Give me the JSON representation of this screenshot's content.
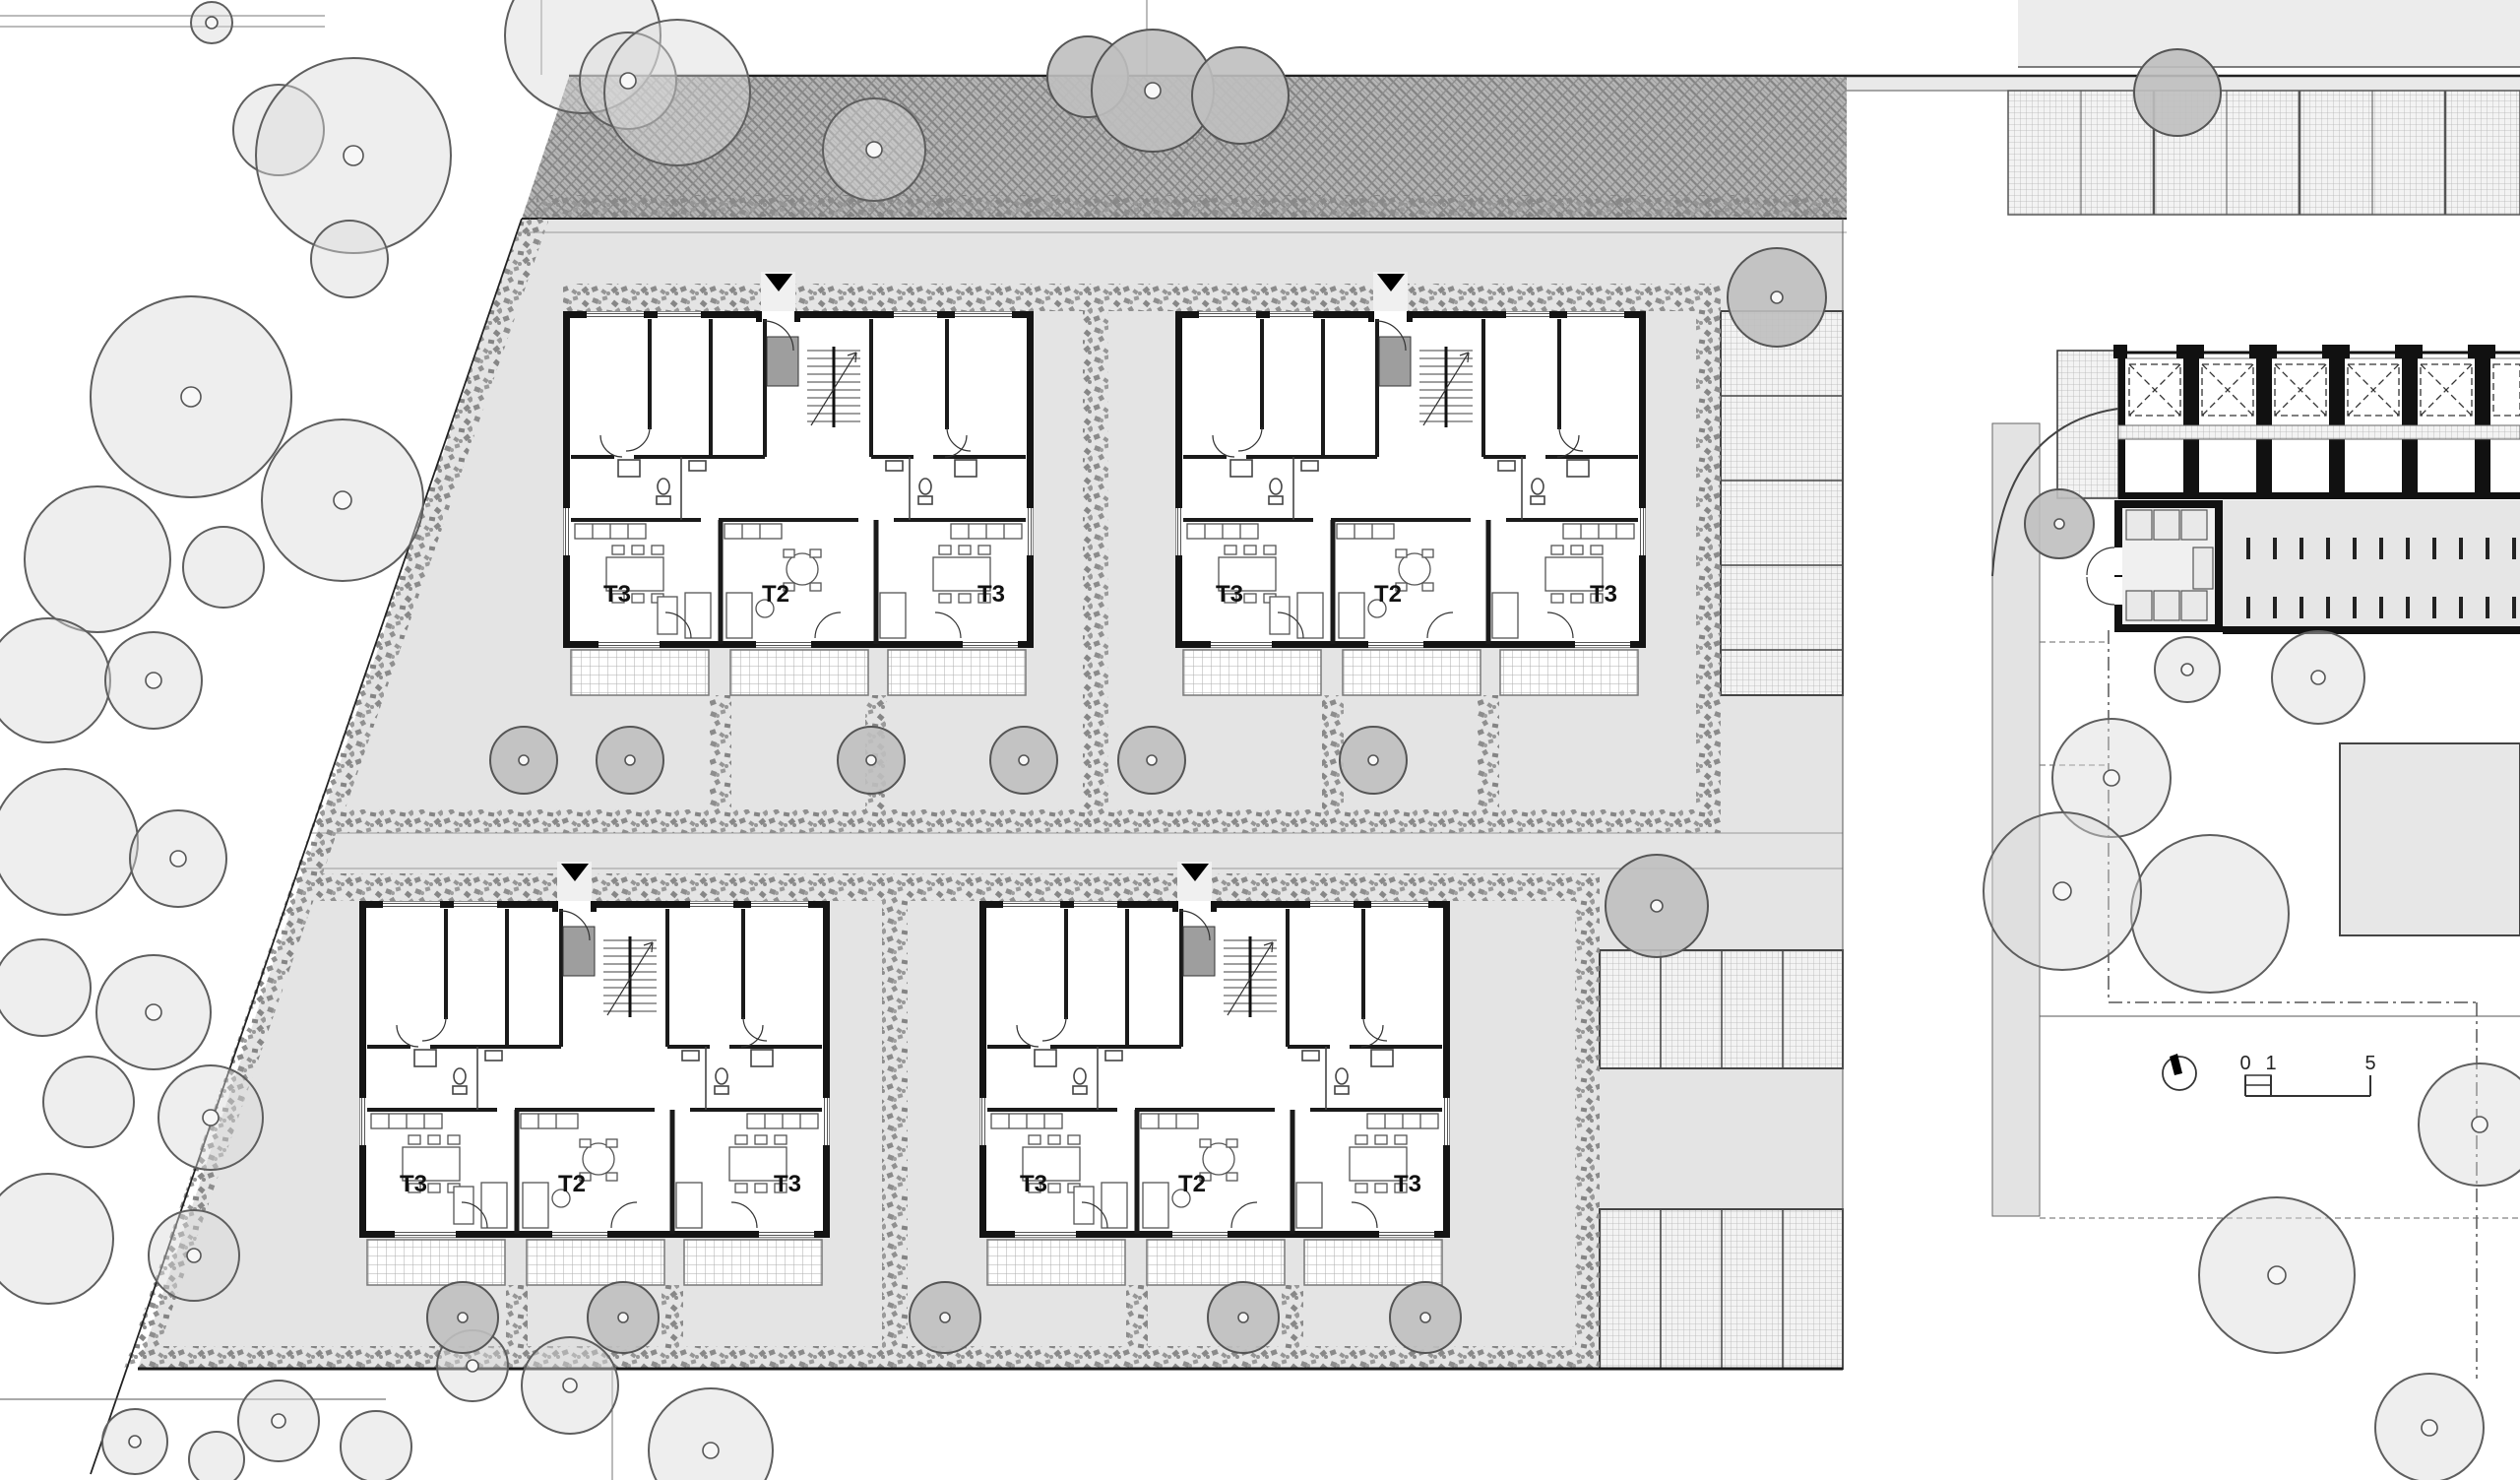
{
  "plan": {
    "kind": "architectural-site-plan",
    "floor": "ground-floor"
  },
  "buildings": [
    {
      "id": "building-a",
      "units": [
        {
          "label": "T3"
        },
        {
          "label": "T2"
        },
        {
          "label": "T3"
        }
      ]
    },
    {
      "id": "building-b",
      "units": [
        {
          "label": "T3"
        },
        {
          "label": "T2"
        },
        {
          "label": "T3"
        }
      ]
    },
    {
      "id": "building-c",
      "units": [
        {
          "label": "T3"
        },
        {
          "label": "T2"
        },
        {
          "label": "T3"
        }
      ]
    },
    {
      "id": "building-d",
      "units": [
        {
          "label": "T3"
        },
        {
          "label": "T2"
        },
        {
          "label": "T3"
        }
      ]
    }
  ],
  "scale_bar": {
    "ticks": [
      "0",
      "1",
      "5"
    ]
  },
  "icons": {
    "north_arrow": "north-arrow-icon",
    "entrance_marker": "entrance-triangle-icon",
    "tree": "tree-icon",
    "hedge": "hedge-texture",
    "road": "road-hatch-texture"
  },
  "colors": {
    "paving": "#e4e4e4",
    "walkway": "#f0f0f0",
    "road_base": "#b7b7b7",
    "hedge": "#8d8d8d",
    "tree_light": "#d9d9d9",
    "tree_dark": "#bfbfbf",
    "wall": "#141414",
    "stair_core": "#9e9e9e",
    "background": "#ffffff"
  }
}
